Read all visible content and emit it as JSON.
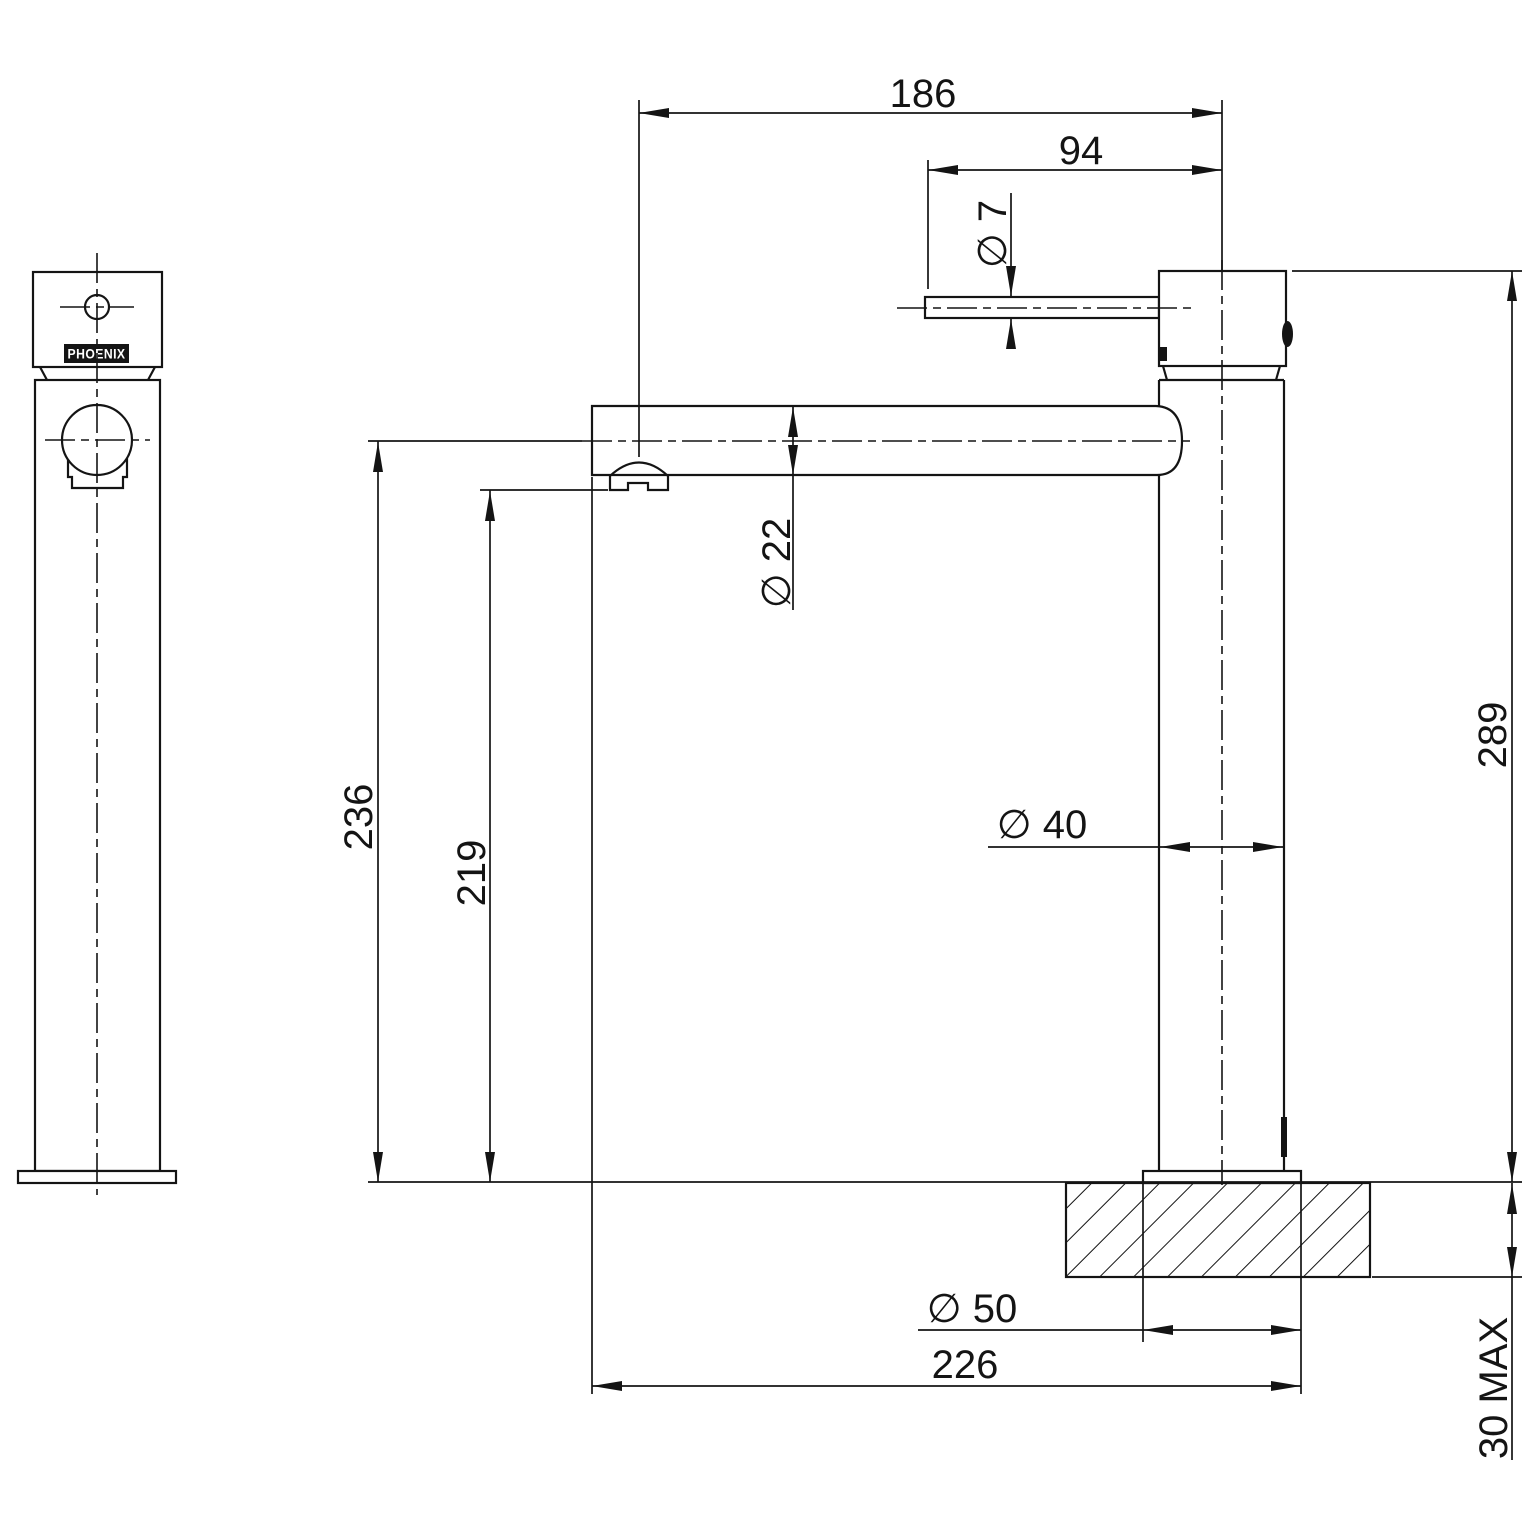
{
  "drawing": {
    "brand_label": "PHOENIX",
    "dimensions": {
      "spout_reach": "186",
      "handle_length": "94",
      "handle_lever_diameter": "∅ 7",
      "spout_diameter": "∅ 22",
      "height_to_spout_centre": "236",
      "height_to_outlet": "219",
      "body_diameter": "∅ 40",
      "overall_height": "289",
      "base_diameter": "∅ 50",
      "overall_depth": "226",
      "max_mounting_thickness": "30 MAX"
    }
  }
}
